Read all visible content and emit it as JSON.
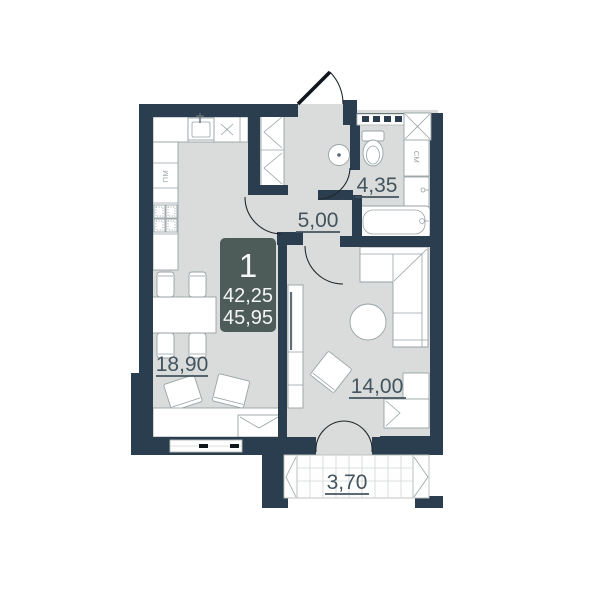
{
  "plan": {
    "badge": {
      "rooms": "1",
      "area1": "42,25",
      "area2": "45,95"
    },
    "rooms": {
      "kitchen_living": {
        "area": "18,90"
      },
      "hallway": {
        "area": "5,00"
      },
      "bathroom": {
        "area": "4,35"
      },
      "living_room": {
        "area": "14,00"
      },
      "balcony": {
        "area": "3,70"
      }
    },
    "appliances": {
      "dishwasher": "ПМ",
      "washer": "СМ"
    },
    "colors": {
      "wall": "#2b3e4f",
      "floor": "#d9dcda",
      "badge": "#4e5c59",
      "label": "#44545f"
    }
  }
}
